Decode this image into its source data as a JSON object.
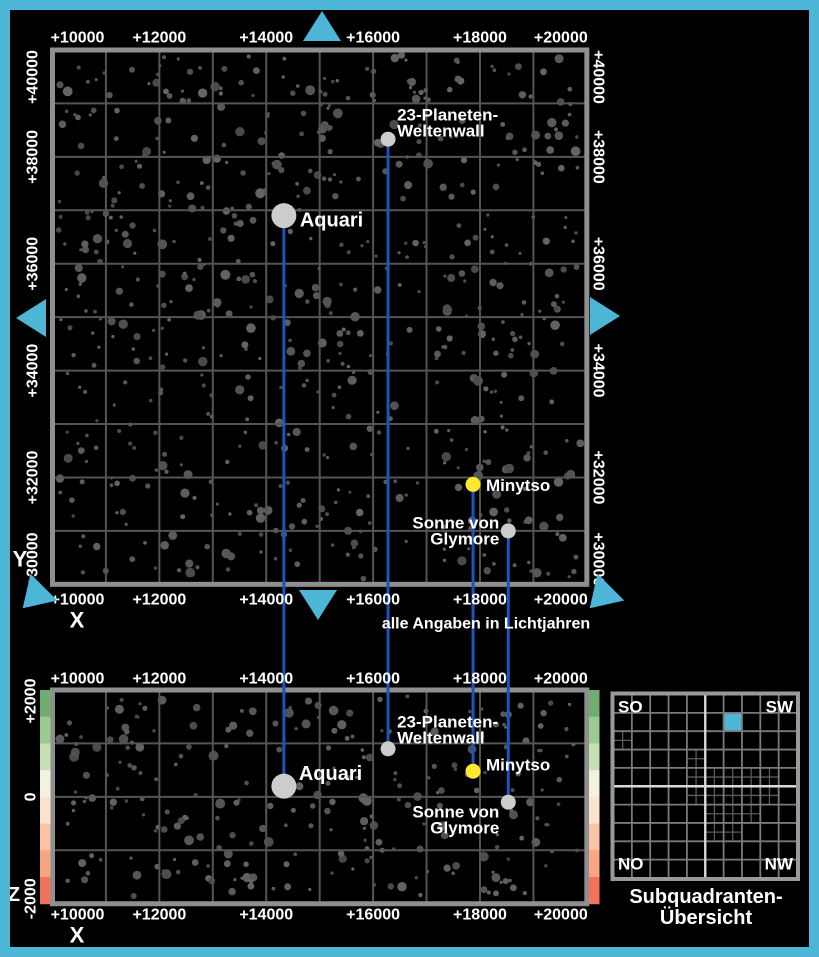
{
  "colors": {
    "frame_cyan": "#4db5d6",
    "background": "#000000",
    "grid_line": "#545454",
    "map_border": "#8f8f8f",
    "field_star": "#5a5a5a",
    "named_star_gray": "#cccccc",
    "named_star_yellow": "#ffe92e",
    "label_green": "#b5db9c",
    "label_white": "#ffffff",
    "connector_blue": "#1d55bd",
    "z_axis_magenta": "#f06eae",
    "overview_line": "#7a7a7a",
    "overview_center_line": "#d9d9d9",
    "overview_sub_line": "#5a5a5a",
    "overview_border": "#9a9a9a",
    "overview_highlight": "#4db5d6"
  },
  "note": "alle Angaben in Lichtjahren",
  "axes": {
    "x": "X",
    "y": "Y",
    "z": "Z"
  },
  "top_map": {
    "x_tick_labels": [
      "+10000",
      "+12000",
      "+14000",
      "+16000",
      "+18000",
      "+20000"
    ],
    "y_tick_labels": [
      "+40000",
      "+38000",
      "+36000",
      "+34000",
      "+32000",
      "+30000"
    ],
    "x_range": [
      10000,
      20000
    ],
    "y_range": [
      30000,
      40000
    ],
    "cell_lightyears": 1000
  },
  "bottom_map": {
    "x_tick_labels": [
      "+10000",
      "+12000",
      "+14000",
      "+16000",
      "+18000",
      "+20000"
    ],
    "z_tick_labels": [
      "+2000",
      "0",
      "-2000"
    ],
    "x_range": [
      10000,
      20000
    ],
    "z_range": [
      -2000,
      2000
    ],
    "cell_lightyears": 1000,
    "z_gradient": [
      "#6fae6f",
      "#9ccb8e",
      "#c6e0b4",
      "#f4f1e2",
      "#fbe3d0",
      "#f9c3a4",
      "#f8a585",
      "#f2735c"
    ]
  },
  "stars": [
    {
      "name": "23-Planeten-Weltenwall",
      "label_lines": [
        "23-Planeten-",
        "Weltenwall"
      ],
      "x": 16280,
      "y": 38330,
      "z": 900,
      "dot": "gray",
      "dot_diameter": 15,
      "label_color": "green",
      "top_label": {
        "anchor": "start",
        "dx": 9,
        "dy": -8,
        "stack": "up",
        "size": 17
      },
      "bottom_label": {
        "anchor": "start",
        "dx": 9,
        "dy": -11,
        "stack": "up",
        "size": 17
      }
    },
    {
      "name": "Aquari",
      "label_lines": [
        "Aquari"
      ],
      "x": 14330,
      "y": 36900,
      "z": 200,
      "dot": "gray",
      "dot_diameter": 25,
      "label_color": "white",
      "top_label": {
        "anchor": "start",
        "dx": 16,
        "dy": 5,
        "stack": "down",
        "size": 20
      },
      "bottom_label": {
        "anchor": "start",
        "dx": 15,
        "dy": -12,
        "stack": "down",
        "size": 20
      }
    },
    {
      "name": "Minytso",
      "label_lines": [
        "Minytso"
      ],
      "x": 17870,
      "y": 31870,
      "z": 480,
      "dot": "yellow",
      "dot_diameter": 15,
      "label_color": "green",
      "top_label": {
        "anchor": "start",
        "dx": 13,
        "dy": 1,
        "stack": "down",
        "size": 17
      },
      "bottom_label": {
        "anchor": "start",
        "dx": 13,
        "dy": -6,
        "stack": "down",
        "size": 17
      }
    },
    {
      "name": "Sonne von Glymore",
      "label_lines": [
        "Sonne von",
        "Glymore"
      ],
      "x": 18530,
      "y": 31000,
      "z": -100,
      "dot": "gray",
      "dot_diameter": 15,
      "label_color": "white",
      "top_label": {
        "anchor": "end",
        "dx": -9,
        "dy": -8,
        "stack": "down",
        "size": 17
      },
      "bottom_label": {
        "anchor": "end",
        "dx": -9,
        "dy": 10,
        "stack": "down",
        "size": 17
      }
    }
  ],
  "triangles": [
    {
      "dir": "up",
      "x": 322,
      "y": 27
    },
    {
      "dir": "left",
      "x": 32,
      "y": 318
    },
    {
      "dir": "right",
      "x": 604,
      "y": 316
    },
    {
      "dir": "down",
      "x": 318,
      "y": 604
    },
    {
      "dir": "sw",
      "x": 34,
      "y": 597
    },
    {
      "dir": "sw",
      "x": 601,
      "y": 597
    }
  ],
  "overview": {
    "corners": {
      "top_left": "SO",
      "top_right": "SW",
      "bottom_left": "NO",
      "bottom_right": "NW"
    },
    "caption_lines": [
      "Subquadranten-",
      "Übersicht"
    ],
    "grid_size": 10,
    "highlight_cell": {
      "row": 1,
      "col": 6
    },
    "subdivided_cells": [
      [
        2,
        0
      ],
      [
        3,
        4
      ],
      [
        4,
        4
      ],
      [
        4,
        5
      ],
      [
        4,
        6
      ],
      [
        4,
        7
      ],
      [
        4,
        8
      ],
      [
        5,
        4
      ],
      [
        5,
        5
      ],
      [
        5,
        6
      ],
      [
        5,
        7
      ],
      [
        5,
        8
      ],
      [
        6,
        5
      ],
      [
        6,
        6
      ],
      [
        6,
        7
      ],
      [
        7,
        5
      ],
      [
        7,
        6
      ]
    ]
  },
  "starfield": {
    "seed": 20,
    "top_count": 640,
    "bottom_count": 255
  }
}
